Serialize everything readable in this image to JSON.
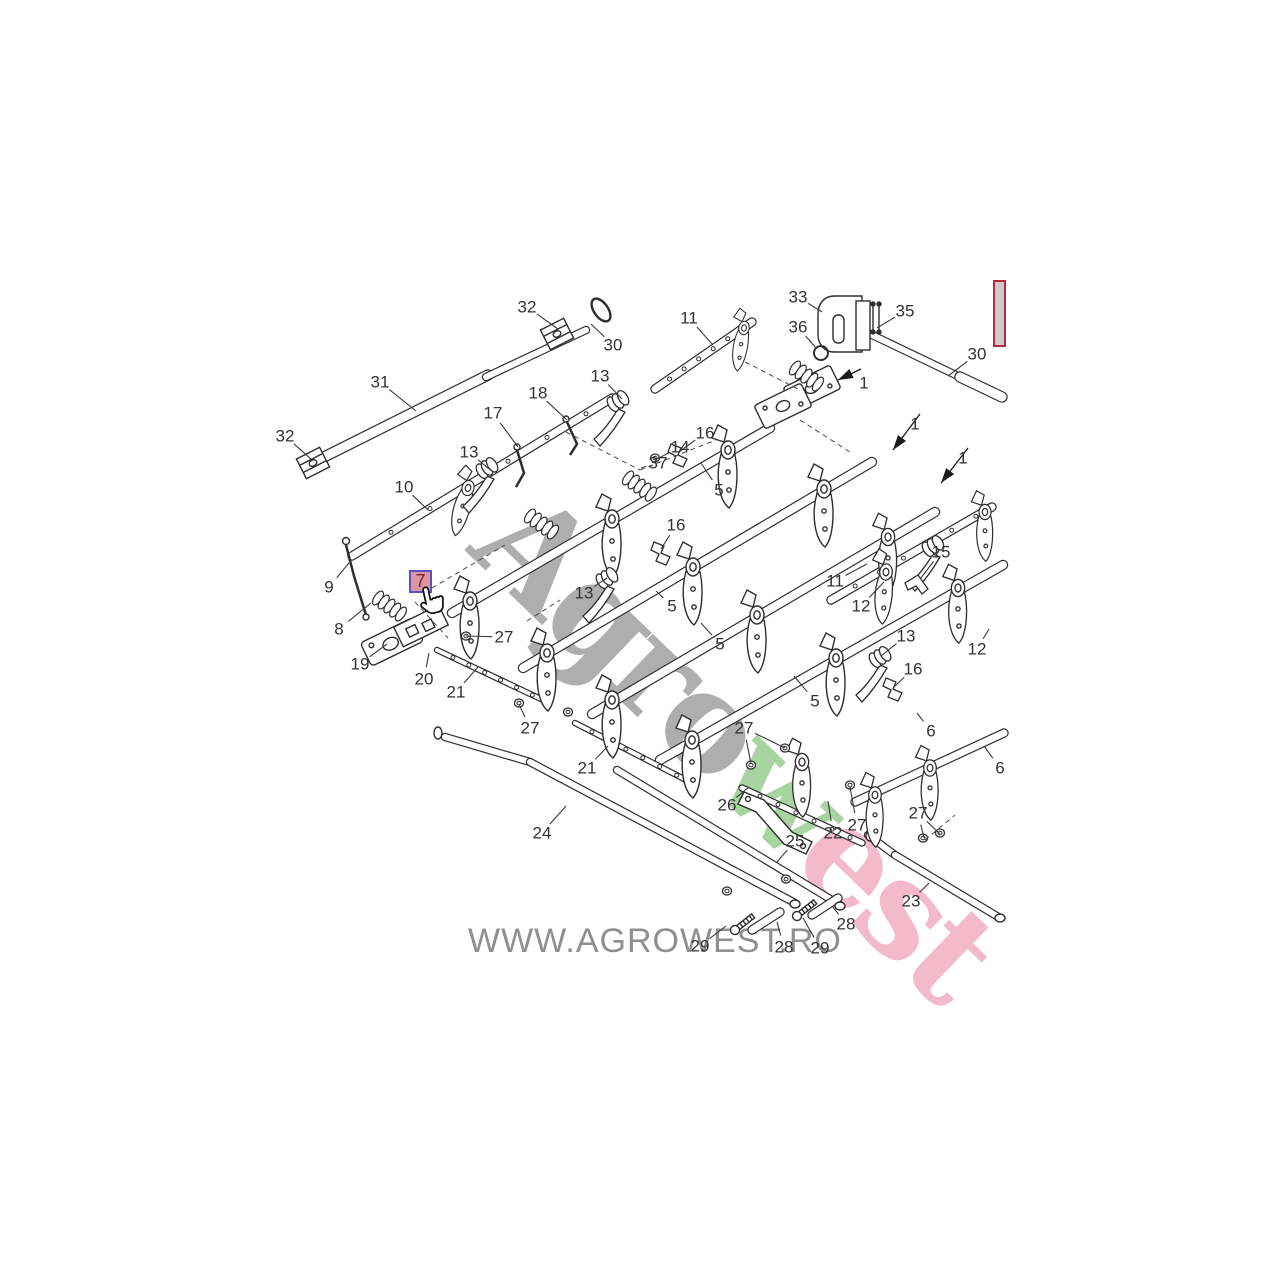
{
  "page": {
    "background": "#ffffff",
    "width": 1280,
    "height": 1280
  },
  "watermark": {
    "part1": "Agro",
    "part2": "w",
    "part3": "est",
    "color1": "#a3a3a3",
    "color2": "#9ccf93",
    "color3": "#f2b1c6"
  },
  "footer": {
    "site_text": "WWW.AGROWEST.RO",
    "color": "#8f8f8f"
  },
  "highlight": {
    "part_number": "7",
    "x": 409,
    "y": 570,
    "width": 23,
    "height": 23,
    "fill": "#dc95a1",
    "border_color": "#5b51c4",
    "text_color": "#7c2230"
  },
  "thumbnail_box": {
    "x": 993,
    "y": 280,
    "width": 13,
    "height": 67,
    "border_color": "#b52b3c",
    "fill": "#cbcbcb"
  },
  "diagram": {
    "stroke_color": "#2e2e2e",
    "label_color": "#333333",
    "labels": [
      {
        "n": "32",
        "x": 527,
        "y": 307,
        "to": [
          [
            558,
            329
          ]
        ]
      },
      {
        "n": "30",
        "x": 613,
        "y": 345,
        "to": [
          [
            591,
            324
          ]
        ]
      },
      {
        "n": "31",
        "x": 380,
        "y": 382,
        "to": [
          [
            416,
            411
          ]
        ]
      },
      {
        "n": "32",
        "x": 285,
        "y": 436,
        "to": [
          [
            311,
            459
          ]
        ]
      },
      {
        "n": "11",
        "x": 689,
        "y": 318,
        "to": [
          [
            712,
            344
          ]
        ]
      },
      {
        "n": "13",
        "x": 600,
        "y": 376,
        "to": [
          [
            622,
            399
          ]
        ]
      },
      {
        "n": "18",
        "x": 538,
        "y": 393,
        "to": [
          [
            567,
            420
          ]
        ]
      },
      {
        "n": "17",
        "x": 493,
        "y": 413,
        "to": [
          [
            518,
            447
          ]
        ]
      },
      {
        "n": "13",
        "x": 469,
        "y": 452,
        "to": [
          [
            489,
            469
          ]
        ]
      },
      {
        "n": "10",
        "x": 404,
        "y": 487,
        "to": [
          [
            428,
            510
          ]
        ]
      },
      {
        "n": "33",
        "x": 798,
        "y": 297,
        "to": [
          [
            822,
            312
          ]
        ]
      },
      {
        "n": "36",
        "x": 798,
        "y": 327,
        "to": [
          [
            816,
            348
          ]
        ]
      },
      {
        "n": "35",
        "x": 905,
        "y": 311,
        "to": [
          [
            877,
            328
          ]
        ]
      },
      {
        "n": "30",
        "x": 977,
        "y": 354,
        "to": [
          [
            948,
            376
          ]
        ]
      },
      {
        "n": "16",
        "x": 705,
        "y": 433,
        "to": [
          [
            679,
            452
          ]
        ]
      },
      {
        "n": "14",
        "x": 680,
        "y": 447,
        "to": [
          [
            657,
            459
          ]
        ]
      },
      {
        "n": "37",
        "x": 658,
        "y": 463,
        "to": [
          [
            641,
            468
          ]
        ]
      },
      {
        "n": "5",
        "x": 719,
        "y": 490,
        "to": [
          [
            701,
            463
          ]
        ]
      },
      {
        "n": "9",
        "x": 329,
        "y": 587,
        "to": [
          [
            349,
            563
          ]
        ]
      },
      {
        "n": "8",
        "x": 339,
        "y": 629,
        "to": [
          [
            371,
            603
          ]
        ]
      },
      {
        "n": "19",
        "x": 360,
        "y": 664,
        "to": [
          [
            387,
            644
          ]
        ]
      },
      {
        "n": "20",
        "x": 424,
        "y": 679,
        "to": [
          [
            429,
            653
          ]
        ]
      },
      {
        "n": "21",
        "x": 456,
        "y": 692,
        "to": [
          [
            478,
            667
          ]
        ]
      },
      {
        "n": "27",
        "x": 504,
        "y": 637,
        "to": [
          [
            466,
            636
          ]
        ]
      },
      {
        "n": "16",
        "x": 676,
        "y": 525,
        "to": [
          [
            661,
            549
          ]
        ]
      },
      {
        "n": "13",
        "x": 584,
        "y": 593,
        "to": [
          [
            607,
            578
          ]
        ]
      },
      {
        "n": "5",
        "x": 672,
        "y": 606,
        "to": [
          [
            656,
            591
          ]
        ]
      },
      {
        "n": "5",
        "x": 720,
        "y": 644,
        "to": [
          [
            701,
            623
          ]
        ]
      },
      {
        "n": "11",
        "x": 835,
        "y": 581,
        "to": [
          [
            867,
            564
          ]
        ]
      },
      {
        "n": "12",
        "x": 861,
        "y": 606,
        "to": [
          [
            884,
            582
          ]
        ]
      },
      {
        "n": "15",
        "x": 941,
        "y": 552,
        "to": [
          [
            920,
            579
          ]
        ]
      },
      {
        "n": "13",
        "x": 906,
        "y": 636,
        "to": [
          [
            881,
            656
          ]
        ]
      },
      {
        "n": "16",
        "x": 913,
        "y": 669,
        "to": [
          [
            894,
            687
          ]
        ]
      },
      {
        "n": "12",
        "x": 977,
        "y": 649,
        "to": [
          [
            989,
            629
          ]
        ]
      },
      {
        "n": "5",
        "x": 815,
        "y": 701,
        "to": [
          [
            794,
            676
          ]
        ]
      },
      {
        "n": "6",
        "x": 931,
        "y": 731,
        "to": [
          [
            917,
            713
          ]
        ]
      },
      {
        "n": "6",
        "x": 1000,
        "y": 768,
        "to": [
          [
            984,
            746
          ]
        ]
      },
      {
        "n": "27",
        "x": 744,
        "y": 728,
        "to": [
          [
            751,
            764
          ],
          [
            785,
            748
          ]
        ]
      },
      {
        "n": "26",
        "x": 727,
        "y": 805,
        "to": [
          [
            749,
            787
          ]
        ]
      },
      {
        "n": "22",
        "x": 833,
        "y": 833,
        "to": [
          [
            828,
            801
          ]
        ]
      },
      {
        "n": "27",
        "x": 857,
        "y": 825,
        "to": [
          [
            850,
            787
          ]
        ]
      },
      {
        "n": "25",
        "x": 795,
        "y": 841,
        "to": [
          [
            777,
            862
          ]
        ]
      },
      {
        "n": "27",
        "x": 918,
        "y": 813,
        "to": [
          [
            924,
            838
          ],
          [
            940,
            834
          ]
        ]
      },
      {
        "n": "23",
        "x": 911,
        "y": 901,
        "to": [
          [
            929,
            883
          ]
        ]
      },
      {
        "n": "28",
        "x": 846,
        "y": 924,
        "to": [
          [
            833,
            907
          ]
        ]
      },
      {
        "n": "29",
        "x": 700,
        "y": 946,
        "to": [
          [
            726,
            926
          ]
        ]
      },
      {
        "n": "28",
        "x": 784,
        "y": 947,
        "to": [
          [
            777,
            922
          ]
        ]
      },
      {
        "n": "29",
        "x": 820,
        "y": 948,
        "to": [
          [
            803,
            918
          ]
        ]
      },
      {
        "n": "24",
        "x": 542,
        "y": 833,
        "to": [
          [
            566,
            806
          ]
        ]
      },
      {
        "n": "21",
        "x": 587,
        "y": 768,
        "to": [
          [
            608,
            746
          ]
        ]
      },
      {
        "n": "27",
        "x": 530,
        "y": 728,
        "to": [
          [
            519,
            704
          ]
        ]
      }
    ],
    "arrows": [
      {
        "n": "1",
        "x": 864,
        "y": 383,
        "tail": [
          861,
          369
        ],
        "tip": [
          838,
          380
        ]
      },
      {
        "n": "1",
        "x": 915,
        "y": 424,
        "tail": [
          920,
          414
        ],
        "tip": [
          893,
          450
        ]
      },
      {
        "n": "1",
        "x": 963,
        "y": 458,
        "tail": [
          968,
          448
        ],
        "tip": [
          941,
          483
        ]
      }
    ]
  }
}
